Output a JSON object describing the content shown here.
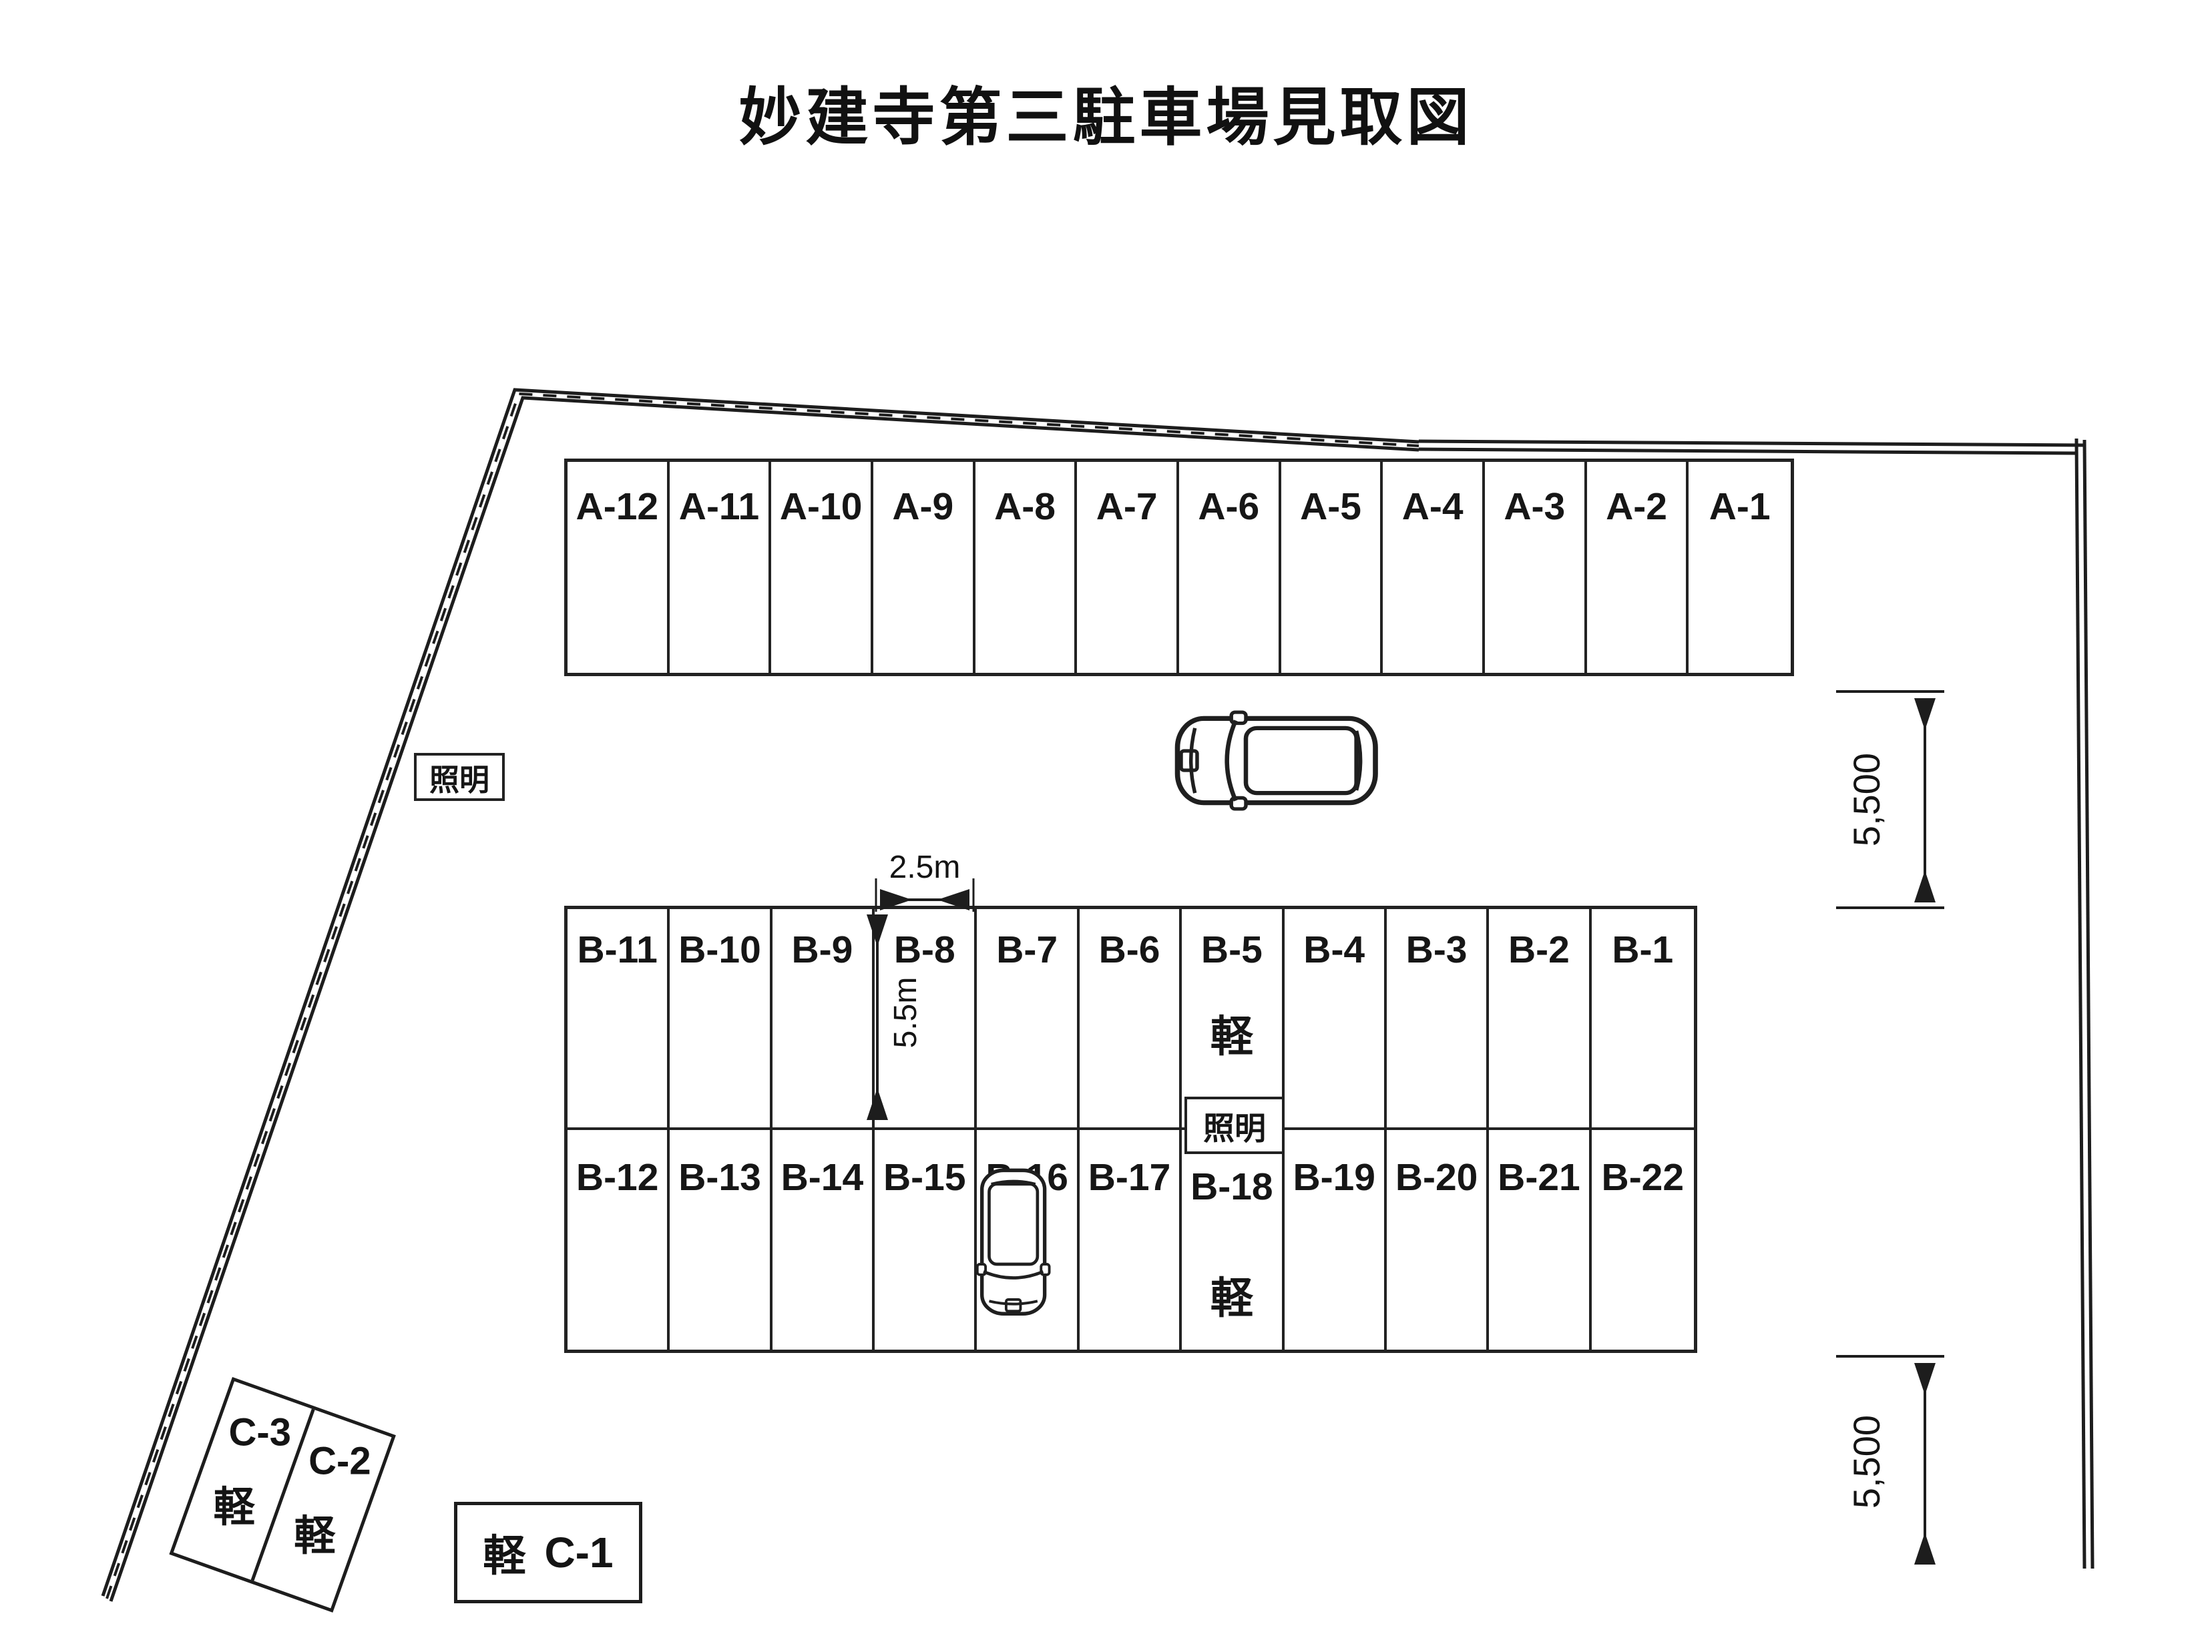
{
  "title": "妙建寺第三駐車場見取図",
  "labels": {
    "kei": "軽",
    "lighting": "照明"
  },
  "stalls": {
    "row_a": [
      "A-12",
      "A-11",
      "A-10",
      "A-9",
      "A-8",
      "A-7",
      "A-6",
      "A-5",
      "A-4",
      "A-3",
      "A-2",
      "A-1"
    ],
    "row_b_top": [
      "B-11",
      "B-10",
      "B-9",
      "B-8",
      "B-7",
      "B-6",
      "B-5",
      "B-4",
      "B-3",
      "B-2",
      "B-1"
    ],
    "row_b_bottom": [
      "B-12",
      "B-13",
      "B-14",
      "B-15",
      "B-16",
      "B-17",
      "B-18",
      "B-19",
      "B-20",
      "B-21",
      "B-22"
    ],
    "c3_label": "C-3",
    "c2_label": "C-2",
    "c1_label": "C-1"
  },
  "dimensions": {
    "stall_width": "2.5m",
    "stall_depth": "5.5m",
    "upper_aisle": "5,500",
    "lower_aisle": "5,500"
  },
  "icons": {
    "car": "car-top-view-icon",
    "boundary": "site-boundary-double-line"
  }
}
